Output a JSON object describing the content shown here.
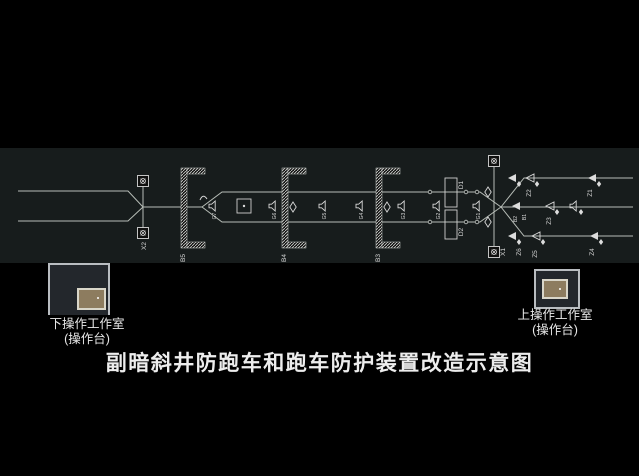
{
  "title": "副暗斜井防跑车和跑车防护装置改造示意图",
  "rooms": {
    "lower": {
      "name": "下操作工作室",
      "sub": "(操作台)"
    },
    "upper": {
      "name": "上操作工作室",
      "sub": "(操作台)"
    }
  },
  "diagram": {
    "barriers": {
      "b5": "B5",
      "b4": "B4",
      "b3": "B3",
      "b2": "B2",
      "b1": "B1"
    },
    "gates": {
      "d1": "D1",
      "d2": "D2"
    },
    "arresters": {
      "z1": "Z1",
      "z2": "Z2",
      "z3": "Z3",
      "z4": "Z4",
      "z5": "Z5",
      "z6": "Z6"
    },
    "winches": {
      "left": "X2",
      "right": "X1"
    },
    "sensors": {
      "g7": "G7",
      "g6": "G6",
      "g5": "G5",
      "g4": "G4",
      "g3": "G3",
      "g2": "G2",
      "g1": "G1"
    }
  },
  "colors": {
    "background": "#000000",
    "band": "#171c1c",
    "line": "#b7bdb7",
    "room_fill": "#23272c",
    "room_border": "#b9bdc1",
    "console_fill": "#8d7c5f",
    "console_border": "#d9d6c9",
    "text": "#e9e9e9"
  }
}
